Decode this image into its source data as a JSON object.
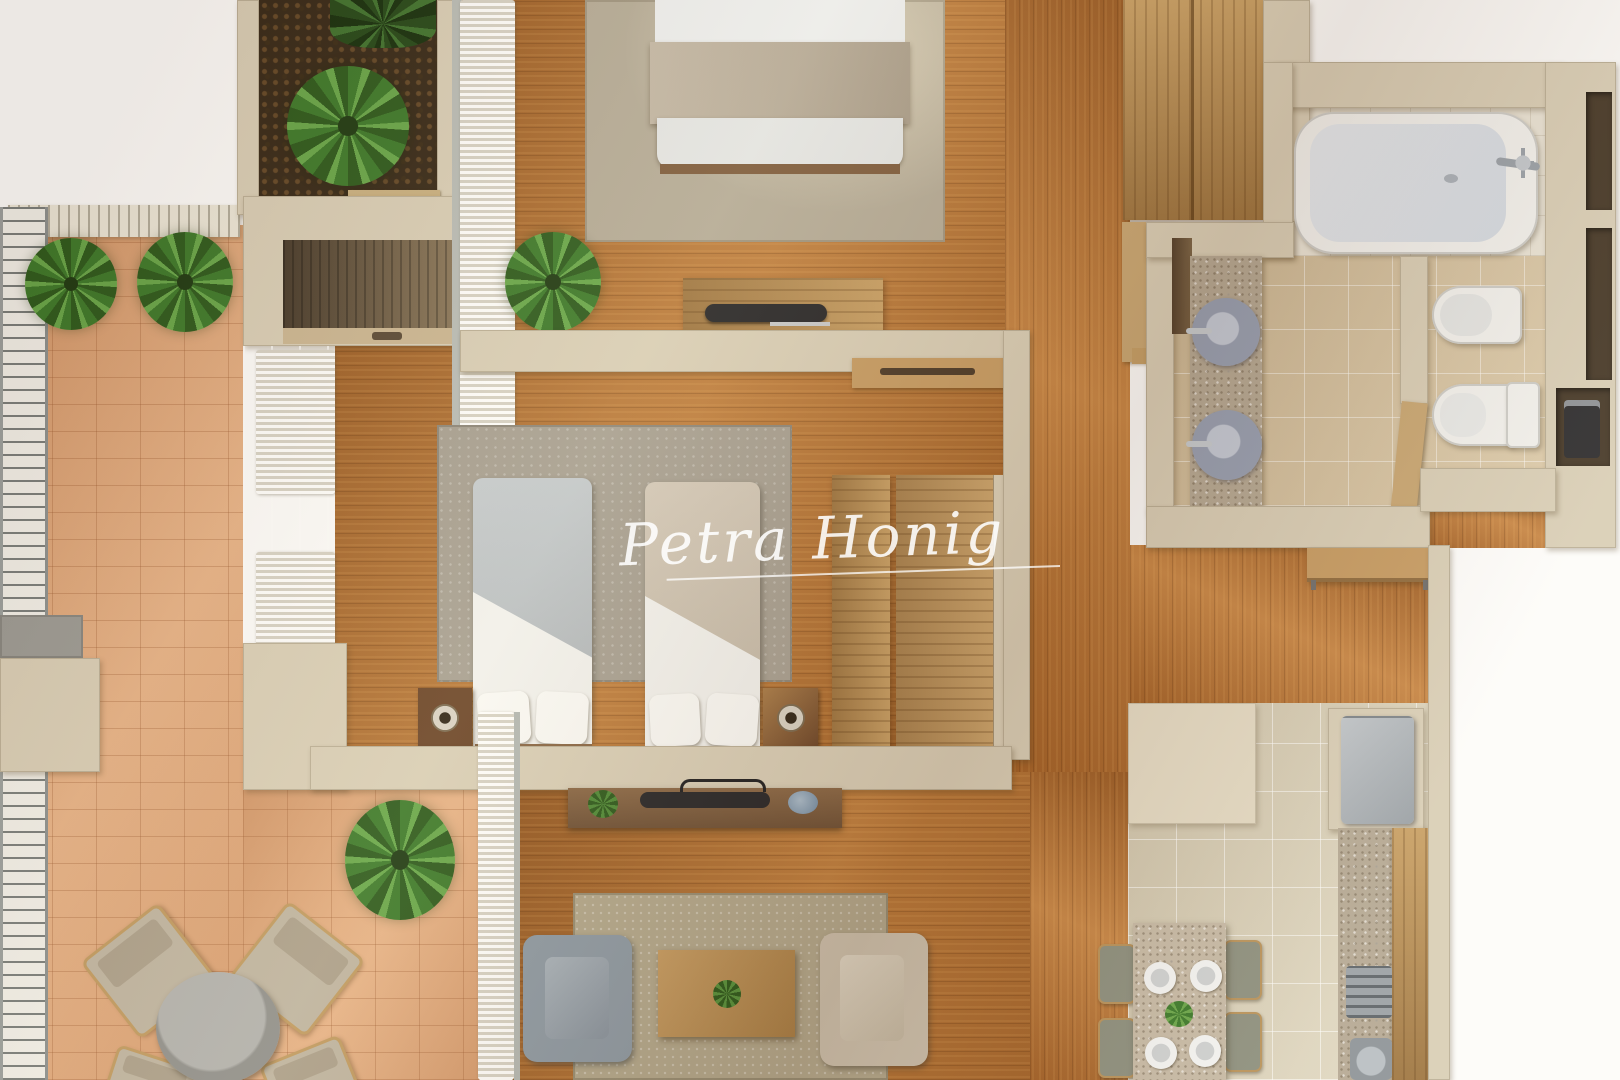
{
  "watermark": {
    "text": "Petra Honig",
    "underlined": true,
    "color": "#ffffff"
  },
  "scene": {
    "type": "3d-floor-plan-top-view",
    "rooms": [
      "terrace",
      "planter",
      "master-bedroom",
      "twin-bedroom",
      "bathroom",
      "wc",
      "hallway",
      "living-room",
      "kitchen-dining"
    ],
    "furniture": [
      "double-bed",
      "twin-bed",
      "twin-bed",
      "nightstand",
      "nightstand",
      "wardrobe",
      "tv-console",
      "tv-console",
      "bathtub",
      "washbasin",
      "washbasin",
      "toilet",
      "bidet",
      "vanity-counter",
      "fridge",
      "kitchen-island",
      "cooktop",
      "kitchen-sink",
      "dining-table",
      "dining-chair",
      "dining-chair",
      "dining-chair",
      "dining-chair",
      "armchair",
      "armchair",
      "coffee-table",
      "outdoor-table",
      "outdoor-chair",
      "outdoor-chair",
      "outdoor-chair",
      "outdoor-chair",
      "hall-shelf",
      "plant",
      "plant",
      "plant",
      "plant",
      "plant",
      "plant"
    ]
  },
  "palette": {
    "background": "#ffffff",
    "wood_floor": "#b06a2c",
    "terrace_tile": "#e0a67a",
    "wall_cream": "#d9cfb9",
    "bath_tile": "#d5c3a4",
    "kitchen_tile": "#dcd4bf",
    "rug_beige": "#b4ab99",
    "rug_gray": "#a7a094",
    "rug_living": "#b2a88e",
    "soil": "#36291a",
    "plant_green": "#3c7a2c",
    "fixture_white": "#f2f2f0",
    "basin_blue_gray": "#97a0b4",
    "armchair_blue": "#8d9aa6",
    "armchair_beige": "#cbc0ae",
    "fridge_gray": "#aeb4ba"
  }
}
